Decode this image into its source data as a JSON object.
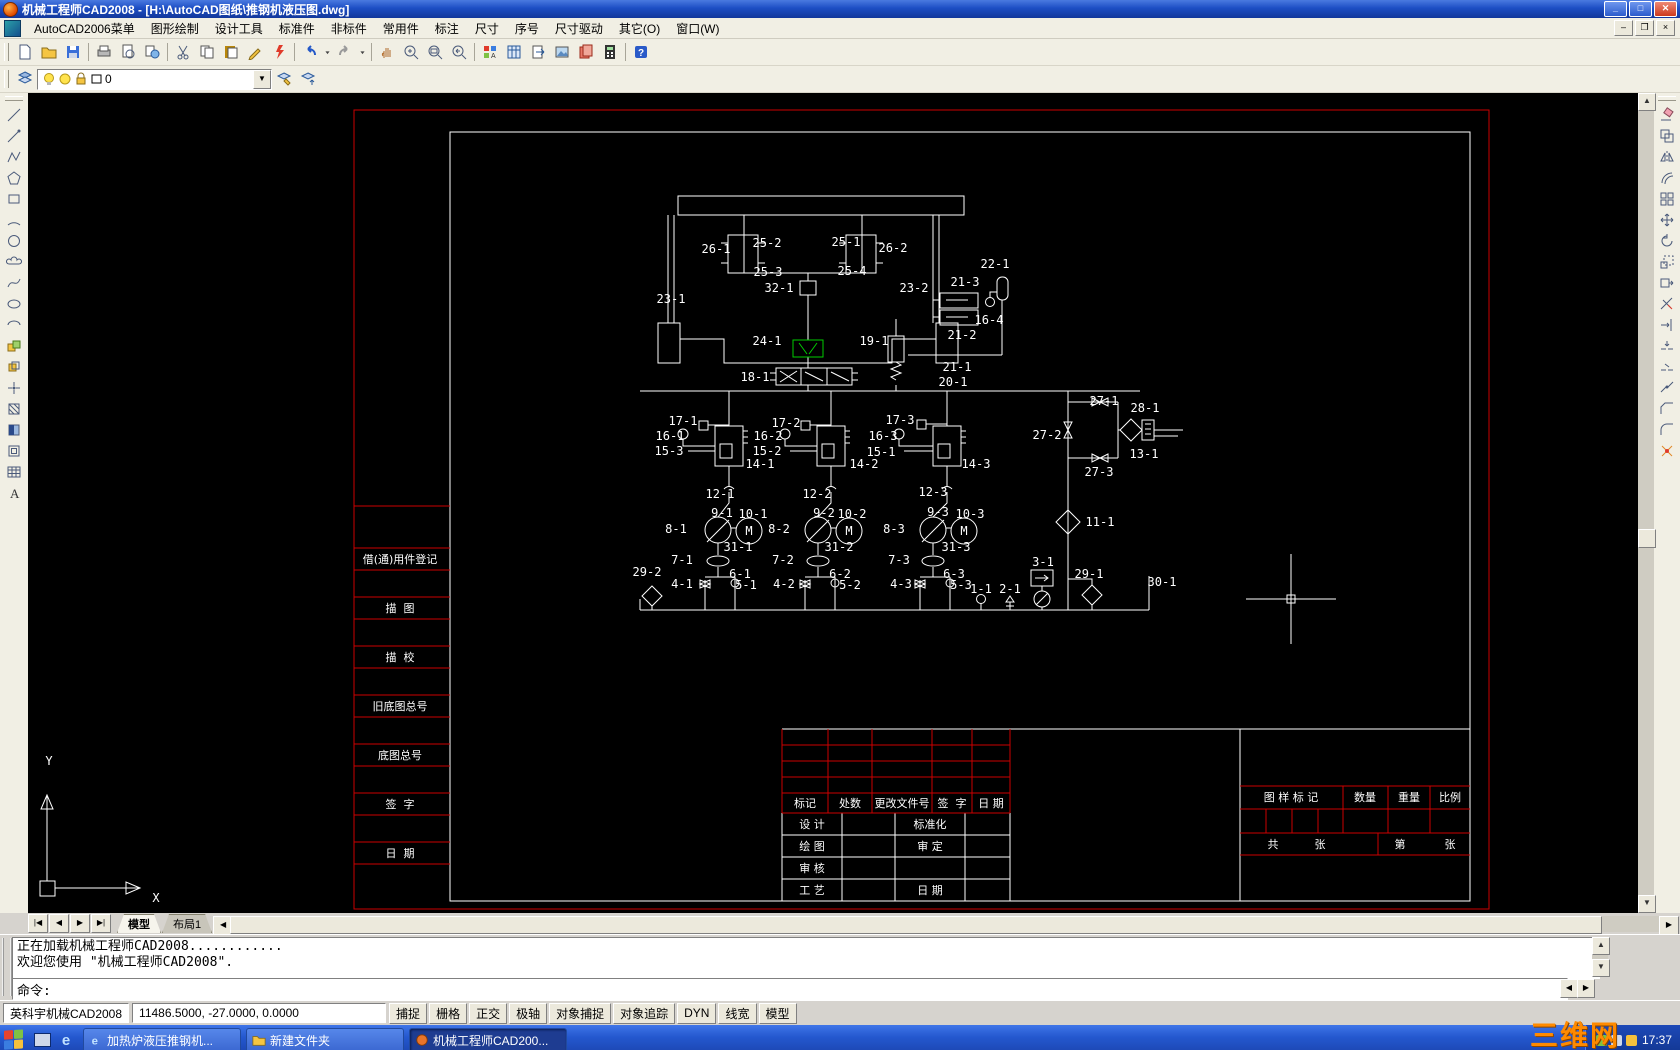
{
  "window": {
    "title": "机械工程师CAD2008 - [H:\\AutoCAD图纸\\推钢机液压图.dwg]"
  },
  "menubar": {
    "items": [
      "AutoCAD2006菜单",
      "图形绘制",
      "设计工具",
      "标准件",
      "非标件",
      "常用件",
      "标注",
      "尺寸",
      "序号",
      "尺寸驱动",
      "其它(O)",
      "窗口(W)"
    ]
  },
  "toolbar1": {
    "groups": [
      [
        "new",
        "open",
        "save"
      ],
      [
        "plot",
        "preview",
        "publish"
      ],
      [
        "cut",
        "copy",
        "paste",
        "pencil",
        "matchprop"
      ],
      [
        "undo",
        "drop",
        "redo",
        "drop"
      ],
      [
        "pan",
        "zoom",
        "zoomwin",
        "zoomprev"
      ],
      [
        "styles",
        "dcenter",
        "tpalettes",
        "sheetset",
        "markup",
        "calc"
      ],
      [
        "help"
      ]
    ]
  },
  "toolbar2": {
    "layers_icon": "layers",
    "combo_icons": [
      "bulb",
      "circ",
      "lock",
      "swatch"
    ],
    "layer_value": "0",
    "right_icons": [
      "layerset",
      "layerprev"
    ]
  },
  "left_toolbar": [
    "line",
    "ray",
    "pline",
    "polygon",
    "rect",
    "arc",
    "circle",
    "cloud",
    "spline",
    "ellipse",
    "earc",
    "iblock",
    "mblock",
    "point",
    "hatch",
    "gradient",
    "region",
    "table",
    "mtext"
  ],
  "right_toolbar": [
    "erase",
    "copyobj",
    "mirror",
    "offset",
    "array",
    "move",
    "rotate",
    "scale",
    "stretch",
    "trim",
    "extend",
    "breakp",
    "break",
    "join",
    "chamfer",
    "fillet",
    "explode"
  ],
  "canvas": {
    "colors": {
      "line": "#ffffff",
      "frame": "#cc0000",
      "highlight": "#00cc00"
    },
    "labels": [
      [
        "26-1",
        688,
        156
      ],
      [
        "25-2",
        739,
        150
      ],
      [
        "25-1",
        818,
        149
      ],
      [
        "26-2",
        865,
        155
      ],
      [
        "25-3",
        740,
        179
      ],
      [
        "25-4",
        824,
        178
      ],
      [
        "23-1",
        643,
        206
      ],
      [
        "32-1",
        751,
        195
      ],
      [
        "23-2",
        886,
        195
      ],
      [
        "22-1",
        967,
        171
      ],
      [
        "21-3",
        937,
        189
      ],
      [
        "16-4",
        961,
        227
      ],
      [
        "21-2",
        934,
        242
      ],
      [
        "24-1",
        739,
        248
      ],
      [
        "19-1",
        846,
        248
      ],
      [
        "21-1",
        929,
        274
      ],
      [
        "20-1",
        925,
        289
      ],
      [
        "18-1",
        727,
        284
      ],
      [
        "17-1",
        655,
        328
      ],
      [
        "16-1",
        642,
        343
      ],
      [
        "15-3",
        641,
        358
      ],
      [
        "14-1",
        732,
        371
      ],
      [
        "17-2",
        758,
        330
      ],
      [
        "16-2",
        740,
        343
      ],
      [
        "15-2",
        739,
        358
      ],
      [
        "14-2",
        836,
        371
      ],
      [
        "17-3",
        872,
        327
      ],
      [
        "16-3",
        855,
        343
      ],
      [
        "15-1",
        853,
        359
      ],
      [
        "14-3",
        948,
        371
      ],
      [
        "27-1",
        1076,
        308
      ],
      [
        "28-1",
        1117,
        315
      ],
      [
        "27-2",
        1019,
        342
      ],
      [
        "13-1",
        1116,
        361
      ],
      [
        "27-3",
        1071,
        379
      ],
      [
        "12-1",
        692,
        401
      ],
      [
        "12-2",
        789,
        401
      ],
      [
        "12-3",
        905,
        399
      ],
      [
        "9-1",
        694,
        420
      ],
      [
        "10-1",
        725,
        421
      ],
      [
        "8-1",
        648,
        436
      ],
      [
        "31-1",
        710,
        454
      ],
      [
        "7-1",
        654,
        467
      ],
      [
        "29-2",
        619,
        479
      ],
      [
        "4-1",
        654,
        491
      ],
      [
        "6-1",
        712,
        481
      ],
      [
        "5-1",
        718,
        492
      ],
      [
        "8-2",
        751,
        436
      ],
      [
        "9-2",
        796,
        420
      ],
      [
        "10-2",
        824,
        421
      ],
      [
        "31-2",
        811,
        454
      ],
      [
        "7-2",
        755,
        467
      ],
      [
        "4-2",
        756,
        491
      ],
      [
        "6-2",
        812,
        481
      ],
      [
        "5-2",
        822,
        492
      ],
      [
        "8-3",
        866,
        436
      ],
      [
        "9-3",
        910,
        419
      ],
      [
        "10-3",
        942,
        421
      ],
      [
        "31-3",
        928,
        454
      ],
      [
        "7-3",
        871,
        467
      ],
      [
        "4-3",
        873,
        491
      ],
      [
        "6-3",
        926,
        481
      ],
      [
        "5-3",
        933,
        492
      ],
      [
        "1-1",
        953,
        496
      ],
      [
        "2-1",
        982,
        496
      ],
      [
        "3-1",
        1015,
        469
      ],
      [
        "29-1",
        1061,
        481
      ],
      [
        "11-1",
        1072,
        429
      ],
      [
        "30-1",
        1134,
        489
      ],
      [
        "M",
        721,
        438
      ],
      [
        "M",
        821,
        438
      ],
      [
        "M",
        936,
        438
      ],
      [
        "Y",
        21,
        668
      ],
      [
        "X",
        128,
        805
      ]
    ],
    "cn_labels": [
      [
        "借(通)用件登记",
        372,
        466
      ],
      [
        "描  图",
        372,
        515
      ],
      [
        "描  校",
        372,
        564
      ],
      [
        "旧底图总号",
        372,
        613
      ],
      [
        "底图总号",
        372,
        662
      ],
      [
        "签  字",
        372,
        711
      ],
      [
        "日  期",
        372,
        760
      ],
      [
        "标记",
        777,
        710
      ],
      [
        "处数",
        822,
        710
      ],
      [
        "更改文件号",
        874,
        710
      ],
      [
        "签  字",
        924,
        710
      ],
      [
        "日 期",
        963,
        710
      ],
      [
        "设 计",
        784,
        731
      ],
      [
        "标准化",
        902,
        731
      ],
      [
        "绘 图",
        784,
        753
      ],
      [
        "审 定",
        902,
        753
      ],
      [
        "审 核",
        784,
        775
      ],
      [
        "工 艺",
        784,
        797
      ],
      [
        "日 期",
        902,
        797
      ],
      [
        "图 样 标 记",
        1263,
        704
      ],
      [
        "数量",
        1337,
        704
      ],
      [
        "重量",
        1381,
        704
      ],
      [
        "比例",
        1422,
        704
      ],
      [
        "共",
        1245,
        751
      ],
      [
        "张",
        1292,
        751
      ],
      [
        "第",
        1372,
        751
      ],
      [
        "张",
        1422,
        751
      ]
    ]
  },
  "tabs": {
    "nav": [
      "first",
      "prev",
      "next",
      "last"
    ],
    "items": [
      {
        "label": "模型",
        "active": true
      },
      {
        "label": "布局1",
        "active": false
      }
    ]
  },
  "command": {
    "history": [
      "正在加载机械工程师CAD2008............",
      "欢迎您使用 \"机械工程师CAD2008\"."
    ],
    "prompt": "命令:"
  },
  "statusbar": {
    "app": "英科宇机械CAD2008",
    "coords": "11486.5000, -27.0000, 0.0000",
    "toggles": [
      "捕捉",
      "栅格",
      "正交",
      "极轴",
      "对象捕捉",
      "对象追踪",
      "DYN",
      "线宽",
      "模型"
    ]
  },
  "taskbar": {
    "tasks": [
      {
        "icon": "ie",
        "label": "加热炉液压推钢机...",
        "active": false
      },
      {
        "icon": "folder",
        "label": "新建文件夹",
        "active": false
      },
      {
        "icon": "cad",
        "label": "机械工程师CAD200...",
        "active": true
      }
    ],
    "tray_icons": [
      "tray-icon-1",
      "tray-icon-2",
      "tray-icon-3"
    ],
    "tray_time": "17:37",
    "watermark": "三维网"
  }
}
